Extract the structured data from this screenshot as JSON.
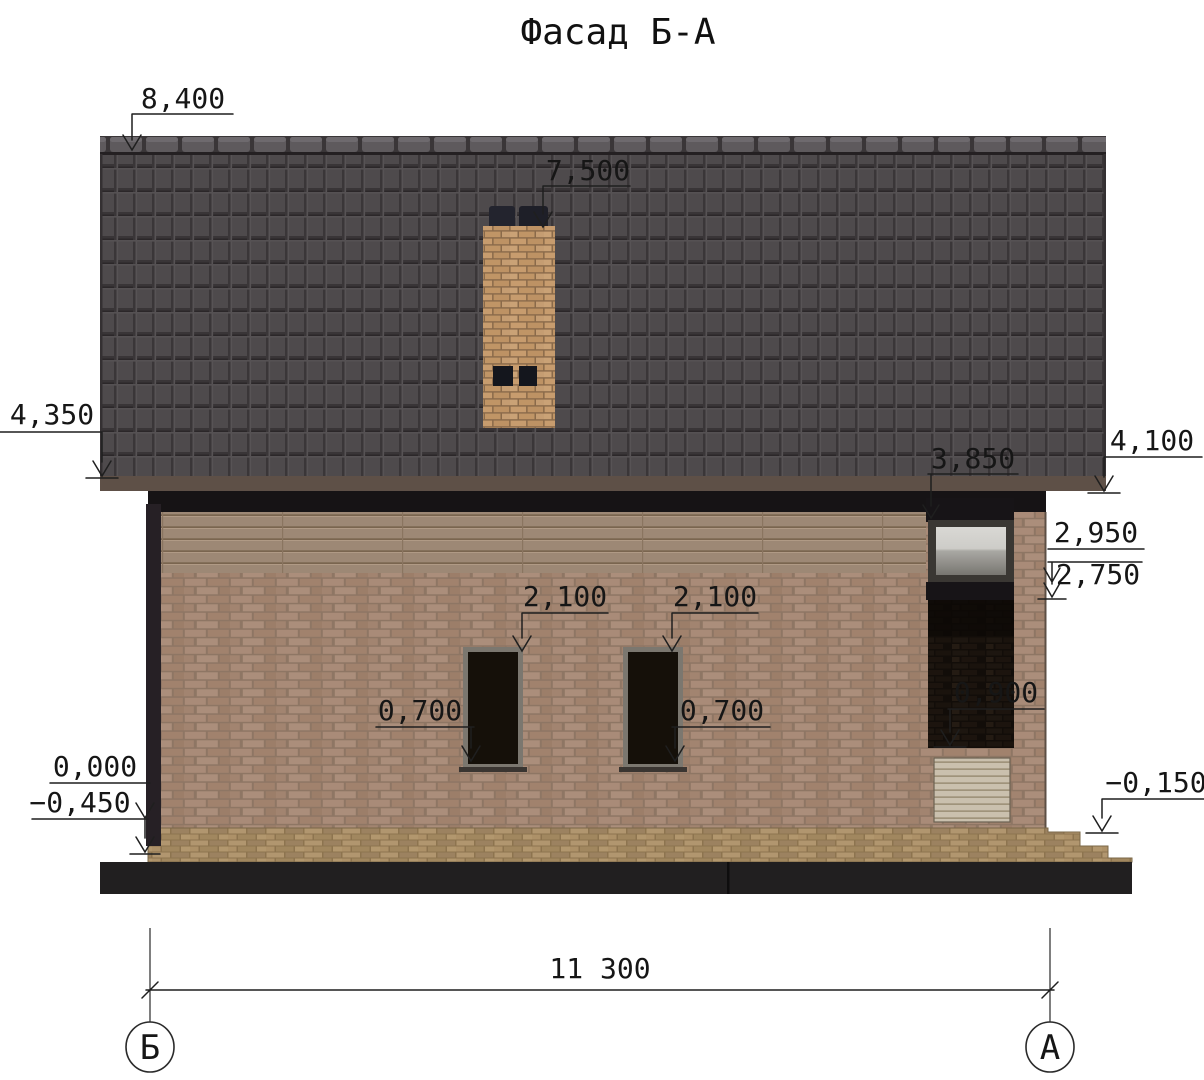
{
  "title": "Фасад Б-А",
  "annotations": {
    "ridge": "8,400",
    "chimney_top": "7,500",
    "eave_left": "4,350",
    "eave_right": "4,100",
    "roof_over_window": "3,850",
    "right_level_upper": "2,950",
    "right_level_lower": "2,750",
    "window_head_left": "2,100",
    "window_head_right": "2,100",
    "window_sill_left": "0,700",
    "window_sill_right": "0,700",
    "entry_opening": "0,900",
    "floor_level": "0,000",
    "ground_level": "−0,450",
    "porch_level": "−0,150",
    "overall_width": "11 300"
  },
  "axes": {
    "left_label": "Б",
    "right_label": "А"
  },
  "colors": {
    "roof": "#4e4a4c",
    "ridge": "#5e5a5d",
    "fascia": "#161315",
    "gutter": "#5e5047",
    "brick_wall": "#a98b78",
    "mortar": "#8e7664",
    "wood_band": "#9d8875",
    "chimney_brick": "#c79c6e",
    "chimney_pot": "#23242e",
    "window_glass_dark": "#151009",
    "window_frame": "#7b776f",
    "attic_glass_light": "#d9d8d4",
    "recess": "#120d09",
    "vent_panel": "#cac0ae",
    "pavement": "#a78d66",
    "foundation": "#211f20",
    "dimension_lines": "#1f1f1f"
  }
}
